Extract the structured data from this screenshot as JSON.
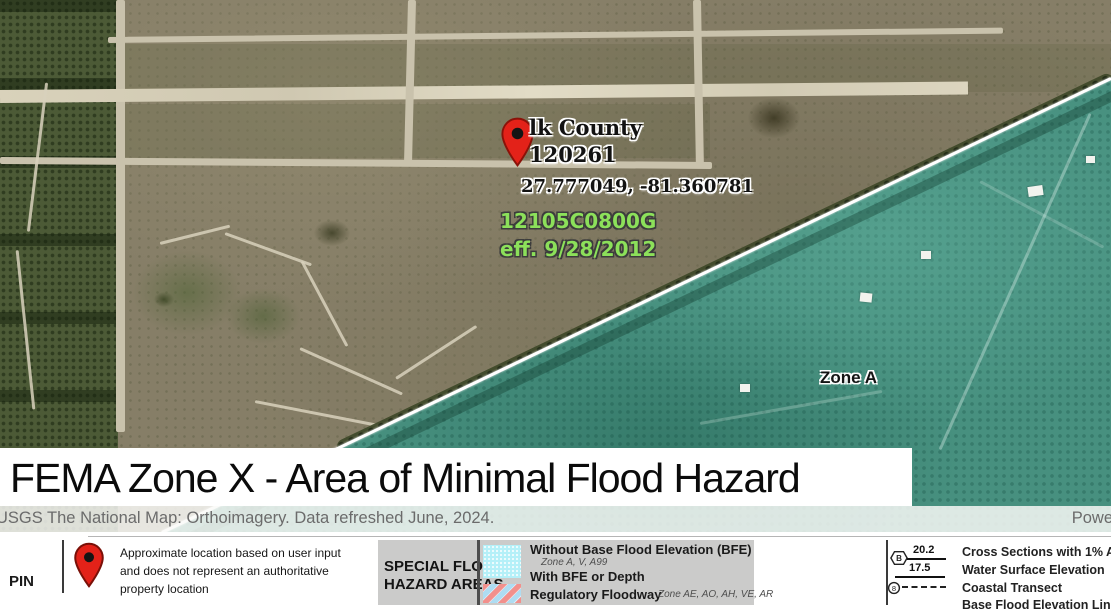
{
  "map": {
    "pin_title": "lk County",
    "pin_community_id": "120261",
    "coordinates": "27.777049, -81.360781",
    "firm_panel": "12105C0800G",
    "firm_effective": "eff. 9/28/2012",
    "zone_label": "Zone A",
    "colors": {
      "flood_zone_tint": "#47907f",
      "firm_text_green": "#8CE05A",
      "pin_red": "#e32219",
      "boundary_line": "#ffffff"
    }
  },
  "banner": {
    "title": "FEMA Zone X - Area of Minimal Flood Hazard"
  },
  "attribution": {
    "left": "USGS The National Map: Orthoimagery. Data refreshed June, 2024.",
    "right": "Powe"
  },
  "legend": {
    "pin": {
      "label": "PIN",
      "description_lines": [
        "Approximate location based on user input",
        "and does not represent an authoritative",
        "property location"
      ]
    },
    "sfha": {
      "title_line1": "SPECIAL FLOOD",
      "title_line2": "HAZARD AREAS",
      "items": [
        {
          "label": "Without Base Flood Elevation (BFE)",
          "sublabel": "Zone A, V, A99"
        },
        {
          "label": "With BFE or Depth"
        },
        {
          "label": "Regulatory Floodway",
          "sublabel": "Zone AE, AO, AH, VE, AR"
        }
      ],
      "swatch_colors": {
        "bfe": "#b4f0f8",
        "floodway_red": "#f2908c",
        "floodway_blue": "#aedcf2"
      }
    },
    "sections": {
      "cross_section_marker": "B",
      "cross_section_value": "20.2",
      "water_surface_value": "17.5",
      "coastal_marker": "8",
      "items": [
        "Cross Sections with 1% Annual",
        "Water Surface Elevation",
        "Coastal Transect",
        "Base Flood Elevation Line (BFE)"
      ]
    }
  }
}
